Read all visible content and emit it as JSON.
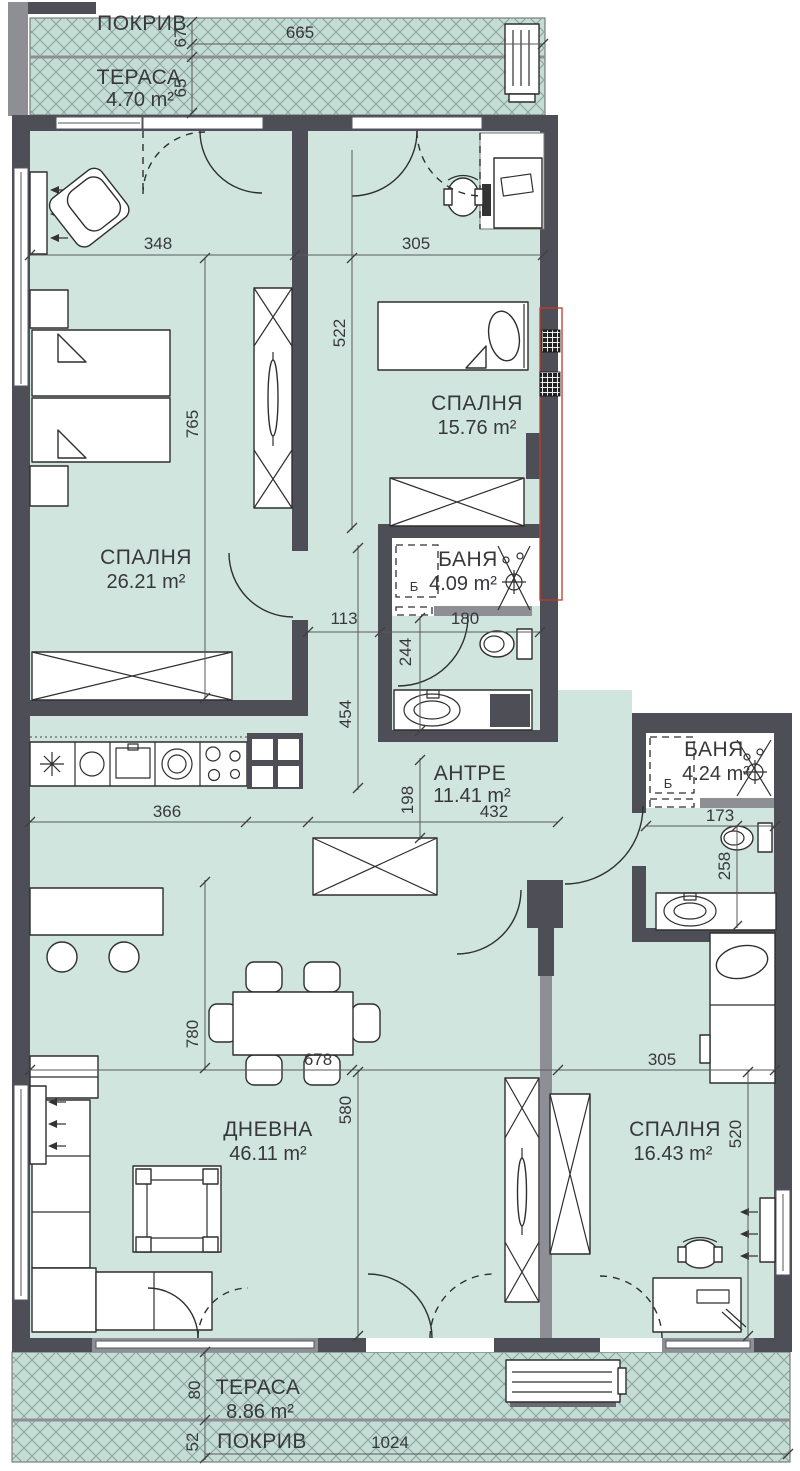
{
  "strips": {
    "top": {
      "roof": "ПОКРИВ",
      "terrace": "ТЕРАСА",
      "terrace_area": "4.70 m²"
    },
    "bottom": {
      "roof": "ПОКРИВ",
      "terrace": "ТЕРАСА",
      "terrace_area": "8.86 m²"
    }
  },
  "rooms": {
    "bedroom1": {
      "name": "СПАЛНЯ",
      "area": "26.21 m²"
    },
    "bedroom2": {
      "name": "СПАЛНЯ",
      "area": "15.76 m²"
    },
    "bedroom3": {
      "name": "СПАЛНЯ",
      "area": "16.43 m²"
    },
    "bath1": {
      "name": "БАНЯ",
      "area": "4.09 m²",
      "washer": "Б"
    },
    "bath2": {
      "name": "БАНЯ",
      "area": "4.24 m²",
      "washer": "Б"
    },
    "hall": {
      "name": "АНТРЕ",
      "area": "11.41 m²"
    },
    "living": {
      "name": "ДНЕВНА",
      "area": "46.11 m²"
    }
  },
  "dims": {
    "top_width": "665",
    "top_roof": "67",
    "top_terrace": "65",
    "b1_w": "348",
    "b2_w": "305",
    "b2_h": "522",
    "b1_h": "765",
    "hall_113": "113",
    "bath1_w": "180",
    "wc1_h": "244",
    "corr_h": "454",
    "kitchen_w": "366",
    "hall_h": "198",
    "hall_w": "432",
    "wc2_w": "173",
    "wc2_h": "258",
    "living_h": "780",
    "dining_w": "678",
    "living_h2": "580",
    "b3_w": "305",
    "b3_h": "520",
    "bot_terrace": "80",
    "bot_roof": "52",
    "bot_width": "1024"
  },
  "colors": {
    "floor": "#cfe5de",
    "terrace_bg": "#c3dcd4",
    "hatch": "#8aa09a",
    "wall": "#4e4e57",
    "wall_light": "#8e8e95",
    "red": "#c0392b"
  }
}
